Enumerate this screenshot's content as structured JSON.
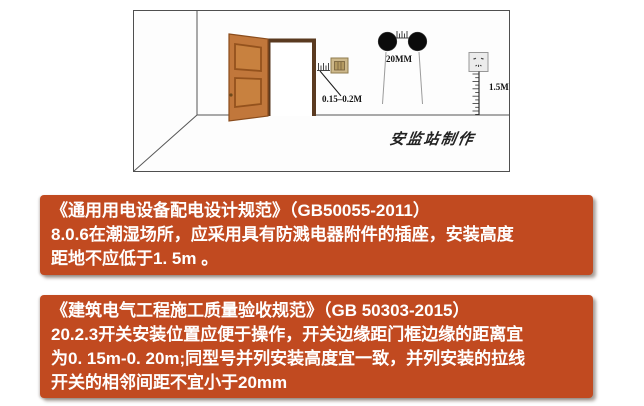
{
  "scene": {
    "annotations": {
      "door_distance": "0.15–0.2M",
      "pull_switch_spacing": "20MM",
      "socket_height": "1.5M"
    },
    "watermark": "安监站制作",
    "icon_names": [
      "door-icon",
      "gap-ruler-icon",
      "wall-switch-icon",
      "pull-cord-switch-icon",
      "socket-icon",
      "height-ruler-icon"
    ]
  },
  "banners": [
    {
      "title": "《通用用电设备配电设计规范》（GB50055-2011）",
      "lines": [
        "8.0.6在潮湿场所，应采用具有防溅电器附件的插座，安装高度",
        "距地不应低于1. 5m 。"
      ]
    },
    {
      "title": "《建筑电气工程施工质量验收规范》（GB 50303-2015）",
      "lines": [
        "20.2.3开关安装位置应便于操作，开关边缘距门框边缘的距离宜",
        "为0. 15m-0. 20m;同型号并列安装高度宜一致，并列安装的拉线",
        "开关的相邻间距不宜小于20mm"
      ]
    }
  ],
  "colors": {
    "banner_bg": "#c14a20",
    "banner_text": "#ffffff",
    "door_leaf": "#c1773b",
    "door_frame": "#5a3a20",
    "pull_switch": "#0b0b0b",
    "wall_switch": "#cdb88b",
    "socket": "#ececec"
  }
}
